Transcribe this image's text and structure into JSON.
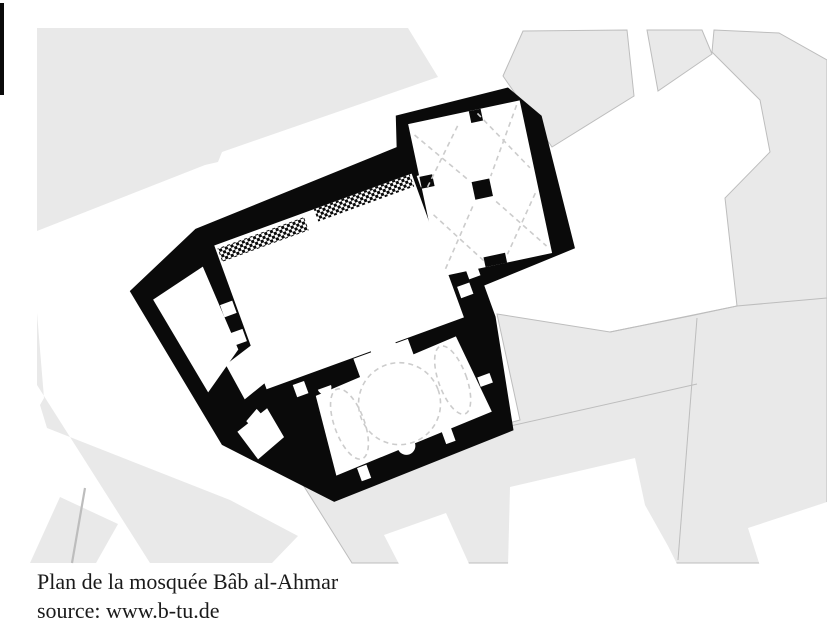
{
  "caption": {
    "title": "Plan de la mosquée Bâb al-Ahmar",
    "source": "source: www.b-tu.de"
  },
  "colors": {
    "background": "#ffffff",
    "building_fill": "#e9e9e9",
    "building_stroke": "#bdbdbd",
    "plan_fill": "#0a0a0a",
    "room_fill": "#ffffff",
    "vault_dash_color": "#cccccc",
    "caption_color": "#1a1a1a"
  }
}
